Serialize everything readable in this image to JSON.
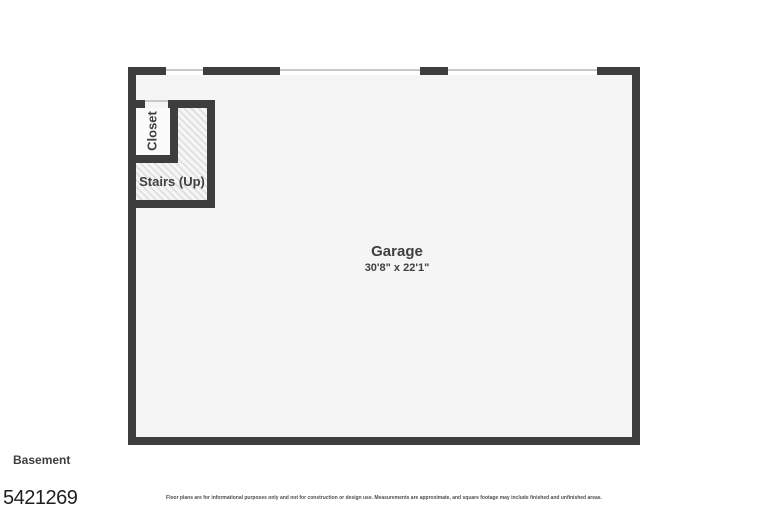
{
  "floorplan": {
    "floor_label": "Basement",
    "listing_id": "5421269",
    "disclaimer": "Floor plans are for informational purposes only and not for construction or design use. Measurements are approximate, and square footage may include finished and unfinished areas.",
    "rooms": {
      "garage": {
        "name": "Garage",
        "dimensions": "30'8\" x 22'1\""
      },
      "closet": {
        "name": "Closet"
      },
      "stairs": {
        "name": "Stairs (Up)"
      }
    },
    "colors": {
      "wall": "#3d3d3d",
      "floor": "#f5f5f5",
      "closet_floor": "#fafafa",
      "hatch_line": "#dcdcdc",
      "window_line": "#c8c8c8",
      "label_text": "#3f3f3f",
      "id_text": "#1f1f1f",
      "disclaimer_text": "#4d4d4d"
    }
  }
}
